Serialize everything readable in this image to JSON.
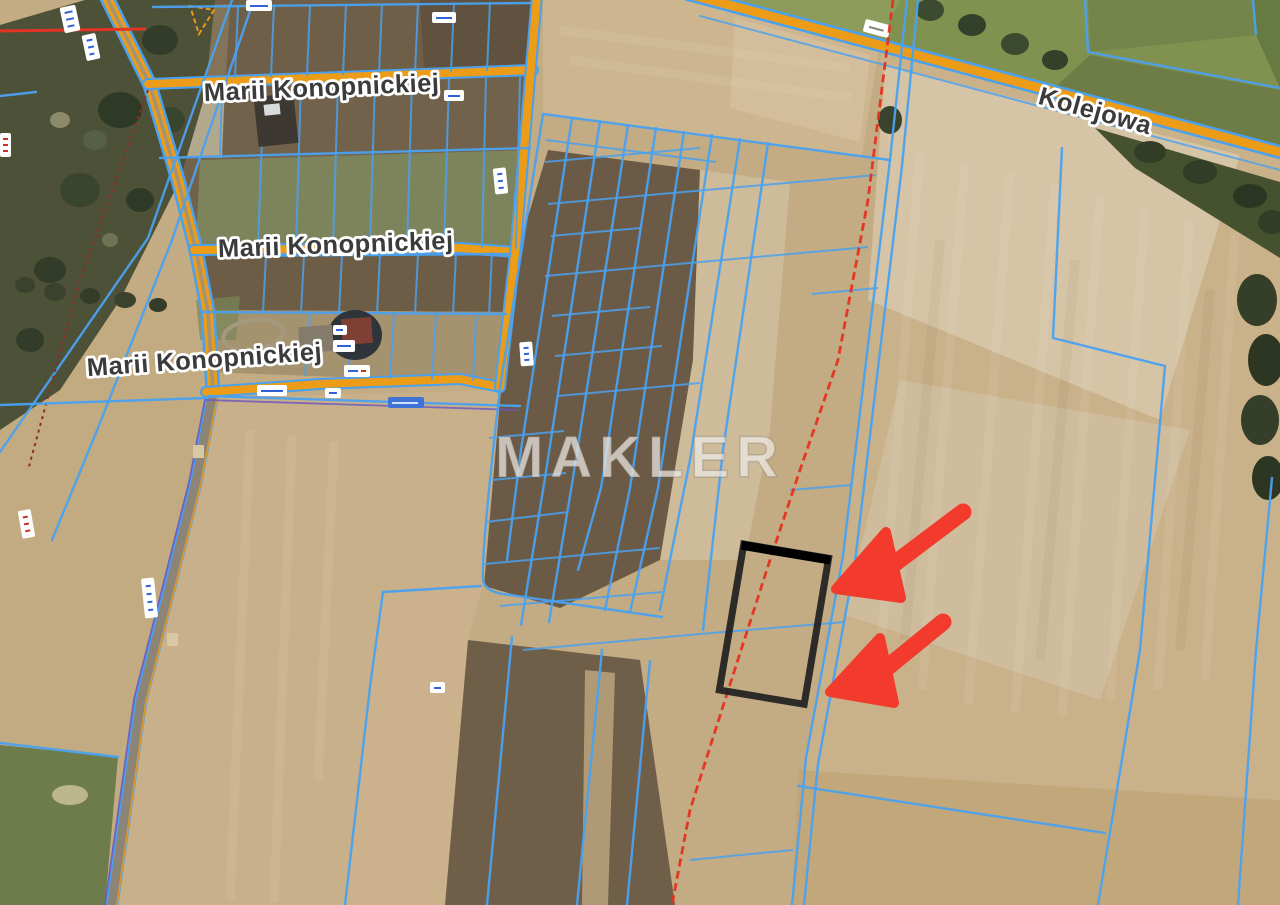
{
  "map": {
    "watermark": "MAKLER",
    "street_labels": [
      {
        "id": "marii-konopnickiej-north",
        "text": "Marii Konopnickiej"
      },
      {
        "id": "marii-konopnickiej-middle",
        "text": "Marii Konopnickiej"
      },
      {
        "id": "marii-konopnickiej-south",
        "text": "Marii Konopnickiej"
      },
      {
        "id": "kolejowa",
        "text": "Kolejowa"
      }
    ],
    "colors": {
      "cadastral_line": "#4aa1ef",
      "road_fill": "#ec9c17",
      "rural_road": "#8c8577",
      "highlighted_parcel_outline": "#1f1f1f",
      "pointer_arrow": "#f23b2c",
      "survey_dashed_line": "#e5311f",
      "watermark": "#eeeae4"
    }
  }
}
